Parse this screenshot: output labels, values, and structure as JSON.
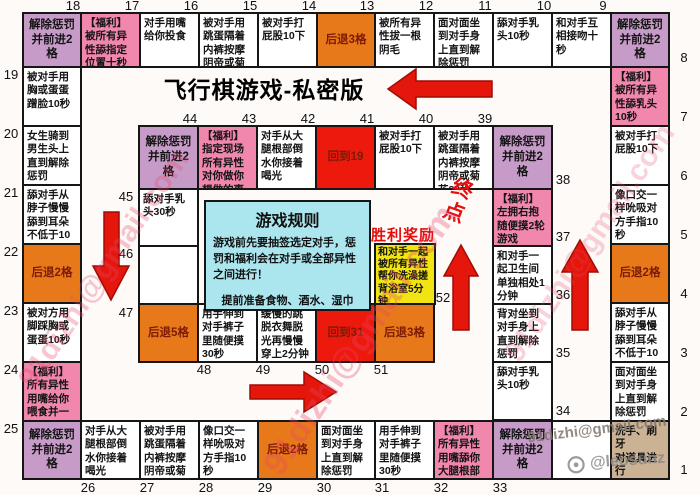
{
  "title": "飞行棋游戏-私密版",
  "rules": {
    "title": "游戏规则",
    "body1": "游戏前先要抽签选定对手，惩罚和福利会在对手或全部异性之间进行！",
    "body2": "提前准备食物、酒水、湿巾"
  },
  "victory": {
    "title": "胜利奖励",
    "text": "和对手一起被所有异性帮你洗澡搓背浴室5分钟",
    "cell_number": "52"
  },
  "endpoint_label": "终点",
  "watermarks": {
    "diagonal": "91dizhi@gmail.com",
    "email": "91dizhi@gmail.com",
    "handle": "@leosunz"
  },
  "colors": {
    "purple": "#c79bc7",
    "pink": "#f287ae",
    "orange": "#e8791b",
    "red": "#ee190d",
    "yellow": "#f2e313",
    "cyan": "#abe6ef",
    "tan": "#cbb294",
    "white": "#ffffff",
    "border": "#161616",
    "arrow": "#e5170c",
    "accent": "#e60d0d"
  },
  "board": {
    "outer_top": [
      {
        "n": "18",
        "text": "解除惩罚\n并前进2格",
        "color": "purple",
        "center": true
      },
      {
        "n": "17",
        "text": "【福利】被所有异性舔指定位置十秒",
        "color": "pink"
      },
      {
        "n": "16",
        "text": "对手用嘴给你投食",
        "color": "white"
      },
      {
        "n": "15",
        "text": "被对手用跳蛋隔着内裤按摩阴帝或菊花30秒",
        "color": "white"
      },
      {
        "n": "14",
        "text": "被对手打屁股10下",
        "color": "white"
      },
      {
        "n": "13",
        "text": "后退3格",
        "color": "orange",
        "center": true
      },
      {
        "n": "12",
        "text": "被所有异性拔一根阴毛",
        "color": "white"
      },
      {
        "n": "11",
        "text": "面对面坐到对手身上直到解除惩罚",
        "color": "white"
      },
      {
        "n": "10",
        "text": "舔对手乳头10秒",
        "color": "white"
      },
      {
        "n": "9",
        "text": "和对手互相接吻十秒",
        "color": "white"
      },
      {
        "n": "8",
        "text": "解除惩罚\n并前进2格",
        "color": "purple",
        "center": true
      }
    ],
    "outer_left": [
      {
        "n": "19",
        "text": "被对手用胸或蛋蛋蹭脸10秒",
        "color": "white"
      },
      {
        "n": "20",
        "text": "女生骑到男生头上直到解除惩罚",
        "color": "white"
      },
      {
        "n": "21",
        "text": "舔对手从脖子慢慢舔到耳朵不低于10秒",
        "color": "white"
      },
      {
        "n": "22",
        "text": "后退2格",
        "color": "orange",
        "center": true
      },
      {
        "n": "23",
        "text": "被对方用脚踩胸或蛋蛋10秒",
        "color": "white"
      },
      {
        "n": "24",
        "text": "【福利】所有异性用嘴给你喂食并一起亲吻你",
        "color": "pink"
      },
      {
        "n": "25",
        "text": "解除惩罚\n并前进2格",
        "color": "purple",
        "center": true
      }
    ],
    "outer_right": [
      {
        "n": "7",
        "text": "【福利】被所有异性舔乳头10秒",
        "color": "pink"
      },
      {
        "n": "6",
        "text": "被对手打屁股10下",
        "color": "white"
      },
      {
        "n": "5",
        "text": "像口交一样吮吸对方手指10秒",
        "color": "white"
      },
      {
        "n": "4",
        "text": "后退2格",
        "color": "orange",
        "center": true
      },
      {
        "n": "3",
        "text": "舔对手从脖子慢慢舔到耳朵不低于10秒",
        "color": "white"
      },
      {
        "n": "2",
        "text": "面对面坐到对手身上直到解除惩罚",
        "color": "white"
      },
      {
        "n": "1",
        "text": "洗手、刷牙\n对道具进行\n消毒",
        "color": "tan"
      }
    ],
    "outer_bottom": [
      {
        "n": "26",
        "text": "对手从大腿根部倒水你接着喝光",
        "color": "white"
      },
      {
        "n": "27",
        "text": "被对手用跳蛋隔着内裤按摩阴帝或菊花30秒",
        "color": "white"
      },
      {
        "n": "28",
        "text": "像口交一样吮吸对方手指10秒",
        "color": "white"
      },
      {
        "n": "29",
        "text": "后退2格",
        "color": "orange",
        "center": true
      },
      {
        "n": "30",
        "text": "面对面坐到对手身上直到解除惩罚",
        "color": "white"
      },
      {
        "n": "31",
        "text": "用手伸到对手裤子里随便摸30秒",
        "color": "white"
      },
      {
        "n": "32",
        "text": "【福利】所有异性用嘴舔你大腿根部30秒",
        "color": "pink"
      },
      {
        "n": "33",
        "text": "解除惩罚\n并前进2格",
        "color": "purple",
        "center": true
      },
      {
        "n": null,
        "text": "",
        "color": "white"
      }
    ],
    "inner_top": [
      {
        "n": "44",
        "text": "解除惩罚\n并前进2格",
        "color": "purple",
        "center": true
      },
      {
        "n": "43",
        "text": "【福利】指定现场所有异性对你做你想做的事",
        "color": "pink"
      },
      {
        "n": "42",
        "text": "对手从大腿根部倒水你接着喝光",
        "color": "white"
      },
      {
        "n": "41",
        "text": "回到19",
        "color": "red",
        "center": true
      },
      {
        "n": "40",
        "text": "被对手打屁股10下",
        "color": "white"
      },
      {
        "n": "39",
        "text": "被对手用跳蛋隔着内裤按摩阴帝或菊花30秒",
        "color": "white"
      },
      {
        "n": "38",
        "text": "解除惩罚\n并前进2格",
        "color": "purple",
        "center": true
      }
    ],
    "inner_left": [
      {
        "n": "45",
        "text": "舔对手乳头30秒",
        "color": "white"
      },
      {
        "n": "46",
        "text": "",
        "color": "white"
      }
    ],
    "inner_right": [
      {
        "n": "37",
        "text": "【福利】左拥右抱随便摸2轮游戏",
        "color": "pink"
      },
      {
        "n": "36",
        "text": "和对手一起卫生间单独相处1分钟",
        "color": "white"
      },
      {
        "n": "35",
        "text": "背对坐到对手身上直到解除惩罚",
        "color": "white"
      },
      {
        "n": "34",
        "text": "舔对手乳头10秒",
        "color": "white"
      }
    ],
    "inner_bottom": [
      {
        "n": "47",
        "text": "后退5格",
        "color": "orange",
        "center": true
      },
      {
        "n": "48",
        "text": "用手伸到对手裤子里随便摸30秒",
        "color": "white"
      },
      {
        "n": "49",
        "text": "缓慢的跳脱衣舞脱光再慢慢穿上2分钟内",
        "color": "white"
      },
      {
        "n": "50",
        "text": "回到31",
        "color": "red",
        "center": true
      },
      {
        "n": "51",
        "text": "后退3格",
        "color": "orange",
        "center": true
      }
    ]
  }
}
